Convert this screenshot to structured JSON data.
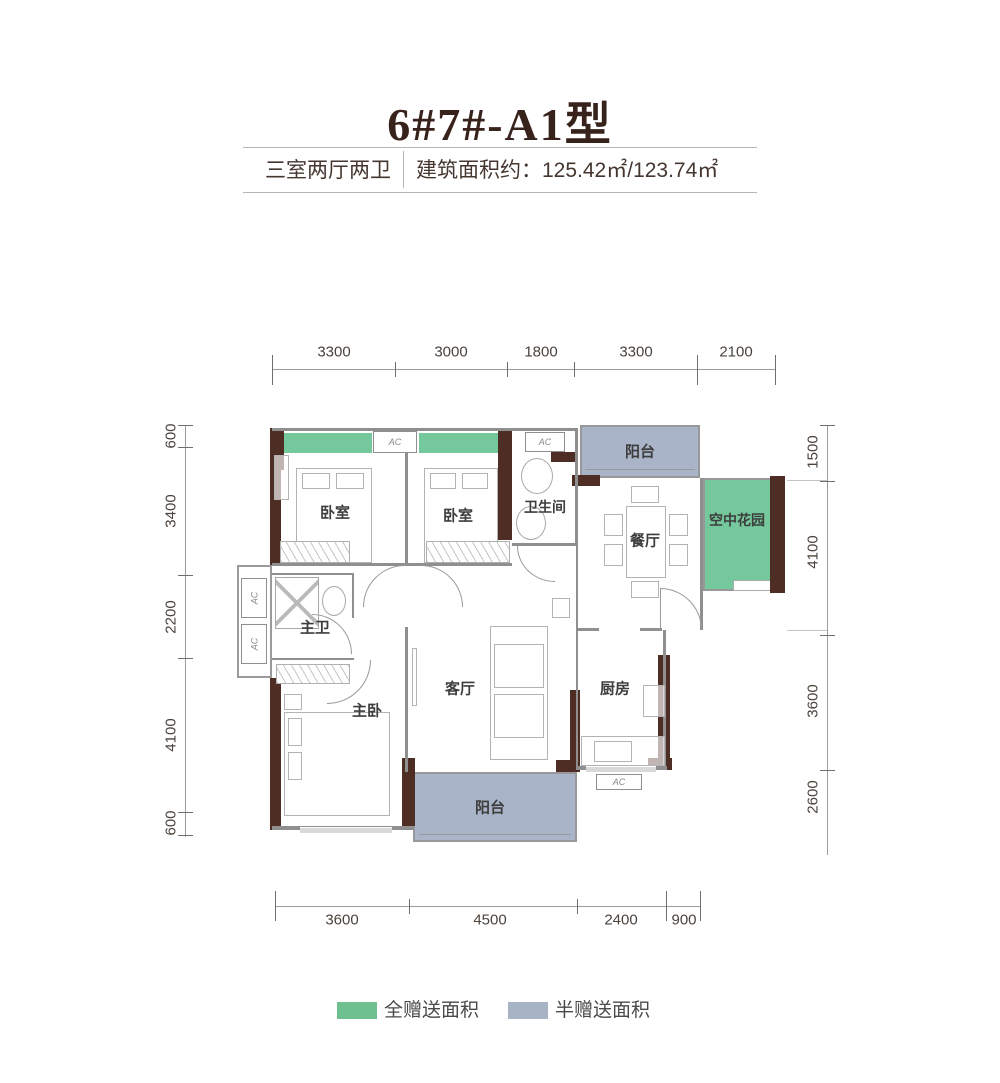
{
  "header": {
    "title": "6#7#-A1型",
    "layout_type": "三室两厅两卫",
    "area_label": "建筑面积约：125.42㎡/123.74㎡"
  },
  "dimensions": {
    "top": [
      "3300",
      "3000",
      "1800",
      "3300",
      "2100"
    ],
    "left": [
      "600",
      "3400",
      "2200",
      "4100",
      "600"
    ],
    "right": [
      "1500",
      "4100",
      "3600",
      "2600"
    ],
    "bottom": [
      "3600",
      "4500",
      "2400",
      "900"
    ]
  },
  "rooms": {
    "bedroom1": "卧室",
    "bedroom2": "卧室",
    "bathroom": "卫生间",
    "balcony_top": "阳台",
    "dining": "餐厅",
    "sky_garden": "空中花园",
    "master_bath": "主卫",
    "master_bedroom": "主卧",
    "living": "客厅",
    "kitchen": "厨房",
    "balcony_bottom": "阳台"
  },
  "ac_label": "AC",
  "legend": {
    "full_gift": "全赠送面积",
    "half_gift": "半赠送面积"
  },
  "colors": {
    "full_gift_green": "#74c89c",
    "half_gift_blue": "#aab4c8",
    "wall_dark_brown": "#4e2d25",
    "title_brown": "#38221c"
  }
}
